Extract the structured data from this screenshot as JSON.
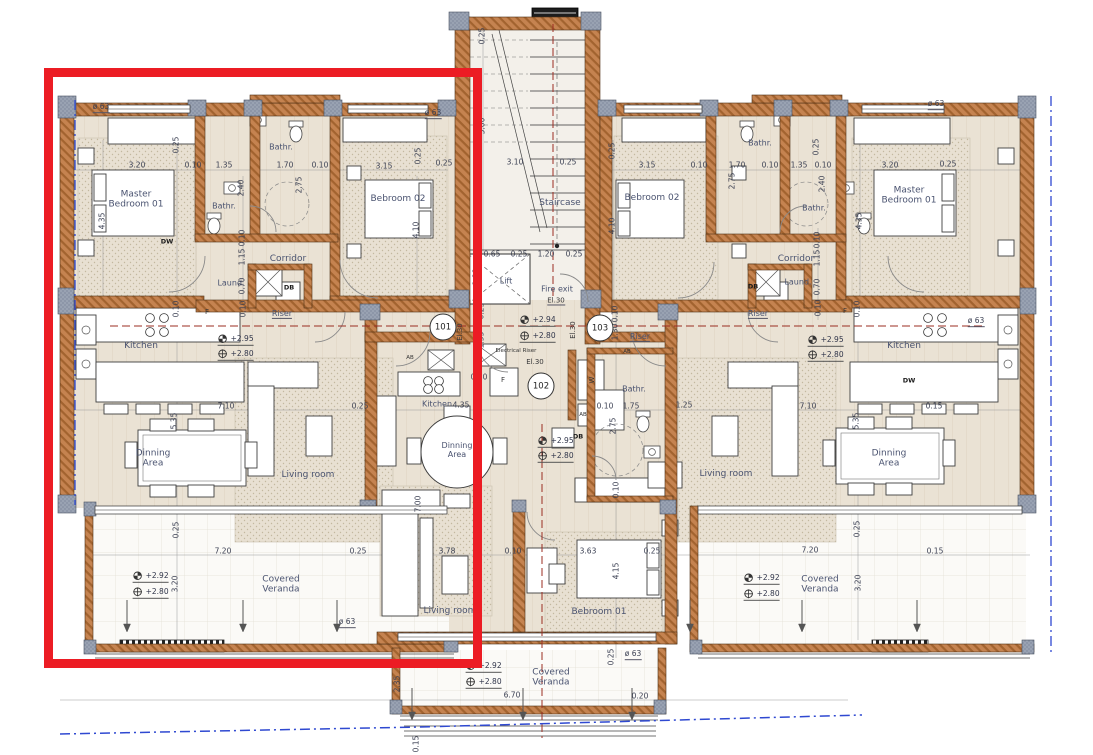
{
  "colors": {
    "highlight": "#ec1c24",
    "wall": "#c58350",
    "column": "#99a2b2",
    "refline_red": "#9b2d22",
    "refline_blue": "#2f49d1"
  },
  "unit_tags": [
    {
      "label": "101",
      "x": 443,
      "y": 327
    },
    {
      "label": "102",
      "x": 541,
      "y": 386
    },
    {
      "label": "103",
      "x": 600,
      "y": 328
    }
  ],
  "annotations": [
    {
      "t": "Master\nBedroom 01",
      "x": 136,
      "y": 200,
      "k": "room",
      "n": "room-label-master-bedroom-left"
    },
    {
      "t": "Bathr.",
      "x": 224,
      "y": 206,
      "k": "rsm",
      "n": "room-label-bathroom-left-inner"
    },
    {
      "t": "Bathr.",
      "x": 281,
      "y": 147,
      "k": "rsm",
      "n": "room-label-bathroom-left-top"
    },
    {
      "t": "Bebroom 02",
      "x": 398,
      "y": 199,
      "k": "room",
      "n": "room-label-bedroom02-left"
    },
    {
      "t": "Corridor",
      "x": 288,
      "y": 259,
      "k": "room",
      "n": "room-label-corridor-left"
    },
    {
      "t": "Laund.",
      "x": 231,
      "y": 283,
      "k": "rsm",
      "n": "room-label-laundry-left"
    },
    {
      "t": "Riser",
      "x": 282,
      "y": 314,
      "k": "rsm",
      "u": 1,
      "n": "room-label-riser-left"
    },
    {
      "t": "Kitchen",
      "x": 141,
      "y": 346,
      "k": "room",
      "n": "room-label-kitchen-left"
    },
    {
      "t": "Dinning\nArea",
      "x": 153,
      "y": 459,
      "k": "room",
      "n": "room-label-dining-left"
    },
    {
      "t": "Living room",
      "x": 308,
      "y": 475,
      "k": "room",
      "n": "room-label-living-left"
    },
    {
      "t": "Covered\nVeranda",
      "x": 281,
      "y": 585,
      "k": "room",
      "n": "room-label-veranda-left"
    },
    {
      "t": "F",
      "x": 207,
      "y": 312,
      "k": "sm"
    },
    {
      "t": "DW",
      "x": 167,
      "y": 242,
      "k": "smb"
    },
    {
      "t": "DB",
      "x": 289,
      "y": 288,
      "k": "smb"
    },
    {
      "t": "+2.95",
      "x": 232,
      "y": 341,
      "k": "level"
    },
    {
      "t": "+2.80",
      "x": 232,
      "y": 356,
      "k": "level"
    },
    {
      "t": "+2.92",
      "x": 147,
      "y": 578,
      "k": "level"
    },
    {
      "t": "+2.80",
      "x": 147,
      "y": 594,
      "k": "level"
    },
    {
      "t": "Staircase",
      "x": 560,
      "y": 203,
      "k": "room",
      "n": "room-label-staircase"
    },
    {
      "t": "Lift",
      "x": 506,
      "y": 281,
      "k": "rsm",
      "n": "room-label-lift"
    },
    {
      "t": "Fire exit",
      "x": 557,
      "y": 289,
      "k": "rsm",
      "n": "room-label-fire-exit"
    },
    {
      "t": "El.30",
      "x": 556,
      "y": 301,
      "k": "sm",
      "u": 1
    },
    {
      "t": "+2.94",
      "x": 534,
      "y": 322,
      "k": "level"
    },
    {
      "t": "+2.80",
      "x": 534,
      "y": 338,
      "k": "level"
    },
    {
      "t": "Electrical Riser",
      "x": 516,
      "y": 351,
      "k": "tiny",
      "n": "room-label-electrical-riser"
    },
    {
      "t": "El.30",
      "x": 535,
      "y": 362,
      "k": "sm"
    },
    {
      "t": "El.30",
      "x": 460,
      "y": 332,
      "k": "sm",
      "r": 1
    },
    {
      "t": "El.30",
      "x": 573,
      "y": 330,
      "k": "sm",
      "r": 1
    },
    {
      "t": "W",
      "x": 592,
      "y": 380,
      "k": "sm",
      "r": 1
    },
    {
      "t": "Bathr.",
      "x": 634,
      "y": 389,
      "k": "rsm",
      "n": "room-label-bathroom-center"
    },
    {
      "t": "AB",
      "x": 583,
      "y": 415,
      "k": "tiny"
    },
    {
      "t": "AB",
      "x": 410,
      "y": 358,
      "k": "tiny"
    },
    {
      "t": "DB",
      "x": 578,
      "y": 437,
      "k": "smb"
    },
    {
      "t": "Kitchen",
      "x": 437,
      "y": 404,
      "k": "rsm",
      "n": "room-label-kitchen-center"
    },
    {
      "t": "Dinning\nArea",
      "x": 457,
      "y": 450,
      "k": "rsm",
      "n": "room-label-dining-center"
    },
    {
      "t": "+2.95",
      "x": 552,
      "y": 443,
      "k": "level"
    },
    {
      "t": "+2.80",
      "x": 552,
      "y": 458,
      "k": "level"
    },
    {
      "t": "F",
      "x": 503,
      "y": 380,
      "k": "sm"
    },
    {
      "t": "Living room",
      "x": 450,
      "y": 611,
      "k": "room",
      "n": "room-label-living-center"
    },
    {
      "t": "Bebroom 01",
      "x": 599,
      "y": 612,
      "k": "room",
      "n": "room-label-bedroom01-center"
    },
    {
      "t": "Covered\nVeranda",
      "x": 551,
      "y": 678,
      "k": "room",
      "n": "room-label-veranda-center"
    },
    {
      "t": "+2.92",
      "x": 480,
      "y": 668,
      "k": "level"
    },
    {
      "t": "+2.80",
      "x": 480,
      "y": 684,
      "k": "level"
    },
    {
      "t": "Bebroom 02",
      "x": 652,
      "y": 198,
      "k": "room",
      "n": "room-label-bedroom02-right"
    },
    {
      "t": "Bathr.",
      "x": 760,
      "y": 143,
      "k": "rsm",
      "n": "room-label-bathroom-right-top"
    },
    {
      "t": "Bathr.",
      "x": 814,
      "y": 208,
      "k": "rsm",
      "n": "room-label-bathroom-right-inner"
    },
    {
      "t": "Master\nBedroom 01",
      "x": 909,
      "y": 196,
      "k": "room",
      "n": "room-label-master-bedroom-right"
    },
    {
      "t": "Corridor",
      "x": 796,
      "y": 259,
      "k": "room",
      "n": "room-label-corridor-right"
    },
    {
      "t": "Laund.",
      "x": 798,
      "y": 282,
      "k": "rsm",
      "n": "room-label-laundry-right"
    },
    {
      "t": "DB",
      "x": 753,
      "y": 287,
      "k": "smb"
    },
    {
      "t": "Riser",
      "x": 640,
      "y": 337,
      "k": "rsm",
      "u": 1,
      "n": "room-label-riser-right-core"
    },
    {
      "t": "Riser",
      "x": 758,
      "y": 314,
      "k": "rsm",
      "u": 1,
      "n": "room-label-riser-right"
    },
    {
      "t": "AB",
      "x": 627,
      "y": 352,
      "k": "tiny"
    },
    {
      "t": "F",
      "x": 845,
      "y": 311,
      "k": "sm"
    },
    {
      "t": "Kitchen",
      "x": 904,
      "y": 346,
      "k": "room",
      "n": "room-label-kitchen-right"
    },
    {
      "t": "DW",
      "x": 909,
      "y": 381,
      "k": "smb"
    },
    {
      "t": "+2.95",
      "x": 822,
      "y": 342,
      "k": "level"
    },
    {
      "t": "+2.80",
      "x": 822,
      "y": 357,
      "k": "level"
    },
    {
      "t": "Dinning\nArea",
      "x": 889,
      "y": 459,
      "k": "room",
      "n": "room-label-dining-right"
    },
    {
      "t": "Living room",
      "x": 726,
      "y": 474,
      "k": "room",
      "n": "room-label-living-right"
    },
    {
      "t": "Covered\nVeranda",
      "x": 820,
      "y": 585,
      "k": "room",
      "n": "room-label-veranda-right"
    },
    {
      "t": "+2.92",
      "x": 758,
      "y": 580,
      "k": "level"
    },
    {
      "t": "+2.80",
      "x": 758,
      "y": 596,
      "k": "level"
    },
    {
      "t": "3.20",
      "x": 137,
      "y": 166,
      "k": "dim"
    },
    {
      "t": "0.10",
      "x": 193,
      "y": 166,
      "k": "dim"
    },
    {
      "t": "1.35",
      "x": 224,
      "y": 166,
      "k": "dim"
    },
    {
      "t": "1.70",
      "x": 285,
      "y": 166,
      "k": "dim"
    },
    {
      "t": "0.10",
      "x": 320,
      "y": 166,
      "k": "dim"
    },
    {
      "t": "3.15",
      "x": 384,
      "y": 167,
      "k": "dim"
    },
    {
      "t": "0.25",
      "x": 444,
      "y": 164,
      "k": "dim"
    },
    {
      "t": "3.10",
      "x": 515,
      "y": 163,
      "k": "dim"
    },
    {
      "t": "0.25",
      "x": 568,
      "y": 163,
      "k": "dim"
    },
    {
      "t": "3.15",
      "x": 647,
      "y": 166,
      "k": "dim"
    },
    {
      "t": "0.10",
      "x": 699,
      "y": 166,
      "k": "dim"
    },
    {
      "t": "1.70",
      "x": 737,
      "y": 166,
      "k": "dim"
    },
    {
      "t": "0.10",
      "x": 770,
      "y": 166,
      "k": "dim"
    },
    {
      "t": "1.35",
      "x": 799,
      "y": 166,
      "k": "dim"
    },
    {
      "t": "0.10",
      "x": 823,
      "y": 166,
      "k": "dim"
    },
    {
      "t": "3.20",
      "x": 890,
      "y": 166,
      "k": "dim"
    },
    {
      "t": "0.25",
      "x": 948,
      "y": 165,
      "k": "dim"
    },
    {
      "t": "0.65",
      "x": 492,
      "y": 255,
      "k": "dim"
    },
    {
      "t": "0.25",
      "x": 519,
      "y": 255,
      "k": "dim"
    },
    {
      "t": "1.20",
      "x": 546,
      "y": 255,
      "k": "dim"
    },
    {
      "t": "0.25",
      "x": 574,
      "y": 255,
      "k": "dim"
    },
    {
      "t": "7.10",
      "x": 226,
      "y": 407,
      "k": "dim"
    },
    {
      "t": "0.25",
      "x": 360,
      "y": 407,
      "k": "dim"
    },
    {
      "t": "4.35",
      "x": 461,
      "y": 406,
      "k": "dim"
    },
    {
      "t": "0.70",
      "x": 479,
      "y": 378,
      "k": "dim"
    },
    {
      "t": "0.10",
      "x": 605,
      "y": 407,
      "k": "dim"
    },
    {
      "t": "1.75",
      "x": 631,
      "y": 407,
      "k": "dim"
    },
    {
      "t": "1.25",
      "x": 684,
      "y": 406,
      "k": "dim"
    },
    {
      "t": "7.10",
      "x": 808,
      "y": 407,
      "k": "dim"
    },
    {
      "t": "0.15",
      "x": 934,
      "y": 407,
      "k": "dim"
    },
    {
      "t": "3.78",
      "x": 447,
      "y": 552,
      "k": "dim"
    },
    {
      "t": "0.10",
      "x": 513,
      "y": 552,
      "k": "dim"
    },
    {
      "t": "3.63",
      "x": 588,
      "y": 552,
      "k": "dim"
    },
    {
      "t": "0.25",
      "x": 652,
      "y": 552,
      "k": "dim"
    },
    {
      "t": "7.20",
      "x": 223,
      "y": 552,
      "k": "dim"
    },
    {
      "t": "0.25",
      "x": 358,
      "y": 552,
      "k": "dim"
    },
    {
      "t": "7.20",
      "x": 810,
      "y": 551,
      "k": "dim"
    },
    {
      "t": "0.15",
      "x": 935,
      "y": 552,
      "k": "dim"
    },
    {
      "t": "6.70",
      "x": 512,
      "y": 696,
      "k": "dim"
    },
    {
      "t": "0.20",
      "x": 640,
      "y": 697,
      "k": "dim"
    },
    {
      "t": "ø 63",
      "x": 101,
      "y": 108,
      "k": "dim",
      "u": 1
    },
    {
      "t": "ø 63",
      "x": 433,
      "y": 114,
      "k": "dim",
      "u": 1
    },
    {
      "t": "ø 63",
      "x": 936,
      "y": 105,
      "k": "dim",
      "u": 1
    },
    {
      "t": "ø 63",
      "x": 347,
      "y": 623,
      "k": "dim",
      "u": 1
    },
    {
      "t": "ø 63",
      "x": 633,
      "y": 655,
      "k": "dim",
      "u": 1
    },
    {
      "t": "ø 63",
      "x": 976,
      "y": 322,
      "k": "dim",
      "u": 1
    },
    {
      "t": "0.25",
      "x": 177,
      "y": 145,
      "k": "dim",
      "r": 1
    },
    {
      "t": "0.25",
      "x": 419,
      "y": 156,
      "k": "dim",
      "r": 1
    },
    {
      "t": "2.40",
      "x": 242,
      "y": 188,
      "k": "dim",
      "r": 1
    },
    {
      "t": "2.75",
      "x": 300,
      "y": 185,
      "k": "dim",
      "r": 1
    },
    {
      "t": "0.10",
      "x": 243,
      "y": 238,
      "k": "dim",
      "r": 1
    },
    {
      "t": "1.15",
      "x": 243,
      "y": 257,
      "k": "dim",
      "r": 1
    },
    {
      "t": "0.70",
      "x": 243,
      "y": 286,
      "k": "dim",
      "r": 1
    },
    {
      "t": "4.35",
      "x": 103,
      "y": 221,
      "k": "dim",
      "r": 1
    },
    {
      "t": "4.10",
      "x": 417,
      "y": 230,
      "k": "dim",
      "r": 1
    },
    {
      "t": "5.35",
      "x": 175,
      "y": 421,
      "k": "dim",
      "r": 1
    },
    {
      "t": "0.10",
      "x": 177,
      "y": 309,
      "k": "dim",
      "r": 1
    },
    {
      "t": "0.10",
      "x": 244,
      "y": 309,
      "k": "dim",
      "r": 1
    },
    {
      "t": "0.25",
      "x": 177,
      "y": 530,
      "k": "dim",
      "r": 1
    },
    {
      "t": "3.20",
      "x": 176,
      "y": 584,
      "k": "dim",
      "r": 1
    },
    {
      "t": "0.25",
      "x": 483,
      "y": 36,
      "k": "dim",
      "r": 1
    },
    {
      "t": "5.00",
      "x": 483,
      "y": 126,
      "k": "dim",
      "r": 1
    },
    {
      "t": "1.88",
      "x": 477,
      "y": 277,
      "k": "dim",
      "r": 1
    },
    {
      "t": "0.25",
      "x": 482,
      "y": 311,
      "k": "dim",
      "r": 1
    },
    {
      "t": "1.55",
      "x": 482,
      "y": 340,
      "k": "dim",
      "r": 1
    },
    {
      "t": "0.10",
      "x": 616,
      "y": 314,
      "k": "dim",
      "r": 1
    },
    {
      "t": "1.30",
      "x": 616,
      "y": 332,
      "k": "dim",
      "r": 1
    },
    {
      "t": "0.25",
      "x": 613,
      "y": 151,
      "k": "dim",
      "r": 1
    },
    {
      "t": "4.10",
      "x": 613,
      "y": 226,
      "k": "dim",
      "r": 1
    },
    {
      "t": "2.75",
      "x": 733,
      "y": 181,
      "k": "dim",
      "r": 1
    },
    {
      "t": "2.40",
      "x": 823,
      "y": 184,
      "k": "dim",
      "r": 1
    },
    {
      "t": "0.25",
      "x": 817,
      "y": 147,
      "k": "dim",
      "r": 1
    },
    {
      "t": "0.10",
      "x": 818,
      "y": 240,
      "k": "dim",
      "r": 1
    },
    {
      "t": "1.15",
      "x": 818,
      "y": 258,
      "k": "dim",
      "r": 1
    },
    {
      "t": "0.70",
      "x": 818,
      "y": 287,
      "k": "dim",
      "r": 1
    },
    {
      "t": "4.35",
      "x": 860,
      "y": 221,
      "k": "dim",
      "r": 1
    },
    {
      "t": "0.10",
      "x": 819,
      "y": 308,
      "k": "dim",
      "r": 1
    },
    {
      "t": "0.10",
      "x": 858,
      "y": 309,
      "k": "dim",
      "r": 1
    },
    {
      "t": "5.35",
      "x": 857,
      "y": 421,
      "k": "dim",
      "r": 1
    },
    {
      "t": "2.75",
      "x": 614,
      "y": 426,
      "k": "dim",
      "r": 1
    },
    {
      "t": "0.10",
      "x": 617,
      "y": 490,
      "k": "dim",
      "r": 1
    },
    {
      "t": "7.00",
      "x": 419,
      "y": 504,
      "k": "dim",
      "r": 1
    },
    {
      "t": "4.15",
      "x": 617,
      "y": 571,
      "k": "dim",
      "r": 1
    },
    {
      "t": "0.25",
      "x": 612,
      "y": 657,
      "k": "dim",
      "r": 1
    },
    {
      "t": "0.25",
      "x": 858,
      "y": 529,
      "k": "dim",
      "r": 1
    },
    {
      "t": "3.20",
      "x": 859,
      "y": 583,
      "k": "dim",
      "r": 1
    },
    {
      "t": "2.35",
      "x": 398,
      "y": 684,
      "k": "dim",
      "r": 1
    },
    {
      "t": "0.15",
      "x": 417,
      "y": 744,
      "k": "dim",
      "r": 1
    }
  ]
}
